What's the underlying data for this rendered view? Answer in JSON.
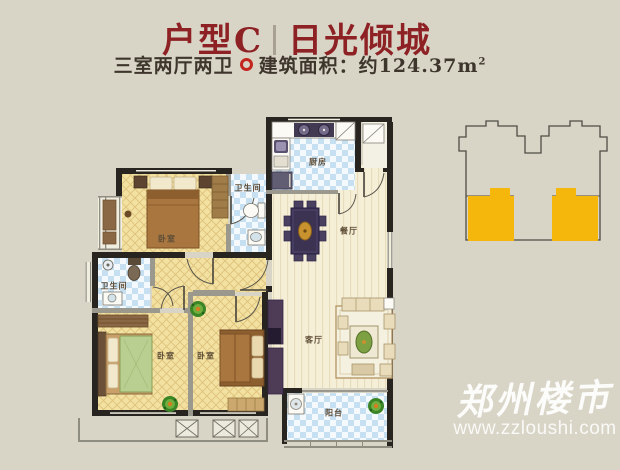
{
  "header": {
    "unit_label": "户型C",
    "project_name": "日光倾城",
    "layout_spec": "三室两厅两卫",
    "area_label": "建筑面积：约124.37m",
    "area_sup": "2"
  },
  "floorplan": {
    "labels": {
      "kitchen": "厨房",
      "dining": "餐厅",
      "bath_top": "卫生间",
      "bath_left": "卫生间",
      "bedroom_top": "卧室",
      "bedroom_left": "卧室",
      "bedroom_mid": "卧室",
      "living": "客厅",
      "balcony": "阳台"
    }
  },
  "locator": {
    "highlight_color": "#f6b70d"
  },
  "watermark": {
    "brand": "郑州楼市",
    "url": "www.zzloushi.com"
  },
  "colors": {
    "background": "#d8d4c6",
    "title_red": "#8e2124",
    "subtitle_text": "#3e362c",
    "divider_dot": "#c3261d",
    "wall": "#282521",
    "floor_yellow": "#f2e1a0",
    "floor_blue": "#c6dff1",
    "floor_cream": "#f6efd7",
    "locator_highlight": "#f6b70d",
    "watermark_white": "#ffffff"
  }
}
